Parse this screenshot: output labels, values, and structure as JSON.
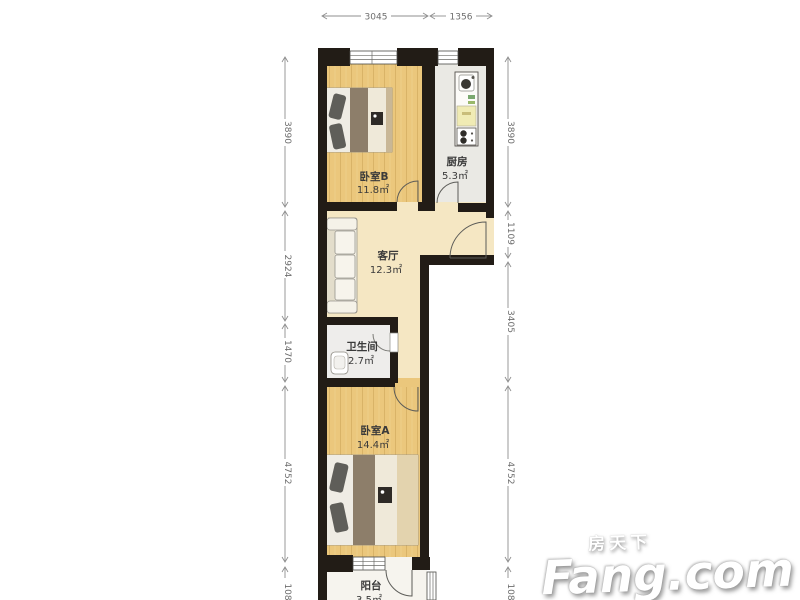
{
  "rooms": {
    "bedroomB": {
      "name": "卧室B",
      "area": "11.8㎡"
    },
    "kitchen": {
      "name": "厨房",
      "area": "5.3㎡"
    },
    "living": {
      "name": "客厅",
      "area": "12.3㎡"
    },
    "bath": {
      "name": "卫生间",
      "area": "2.7㎡"
    },
    "bedroomA": {
      "name": "卧室A",
      "area": "14.4㎡"
    },
    "balcony": {
      "name": "阳台",
      "area": "3.5㎡"
    }
  },
  "dims": {
    "top1": "3045",
    "top2": "1356",
    "left1": "3890",
    "left2": "2924",
    "left3": "1470",
    "left4": "4752",
    "left5": "108",
    "right1": "3890",
    "right2": "1109",
    "right3": "3405",
    "right4": "4752",
    "right5": "108"
  },
  "watermark": {
    "brand_cn": "房天下",
    "brand_en": "Fang.com"
  },
  "colors": {
    "wall": "#221c16",
    "wood_floor": "#ebc77c",
    "living_floor": "#f5e7c3",
    "kitchen_floor": "#eae9e4",
    "bath_floor": "#eeedeb",
    "balcony_floor": "#f6f4ee"
  }
}
